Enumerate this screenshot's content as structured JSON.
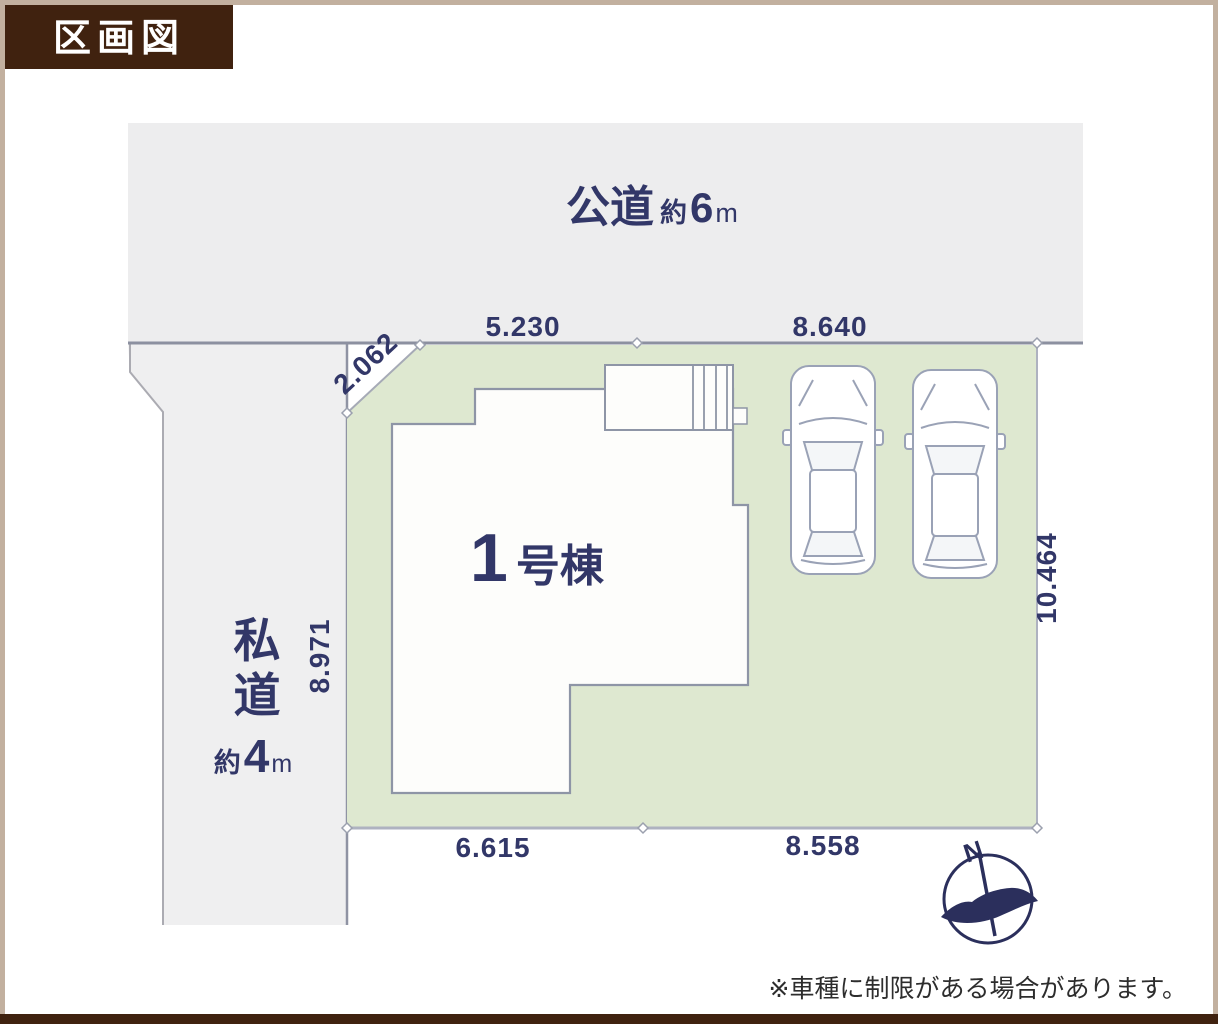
{
  "colors": {
    "brand_brown": "#40220F",
    "frame_beige": "#C2B09F",
    "navy_text": "#323768",
    "plot_green": "#DEE8D0",
    "road_gray": "#EDEDEE",
    "compass_navy": "#2B2F5C"
  },
  "badge": {
    "label": "区画図"
  },
  "roads": {
    "public": {
      "name": "公道",
      "approx": "約",
      "width": "6",
      "unit": "m"
    },
    "private": {
      "char1": "私",
      "char2": "道",
      "approx": "約",
      "width": "4",
      "unit": "m"
    }
  },
  "building": {
    "number": "1",
    "suffix": "号棟"
  },
  "dimensions": {
    "corner_diagonal": "2.062",
    "north_left": "5.230",
    "north_right": "8.640",
    "west": "8.971",
    "east": "10.464",
    "south_left": "6.615",
    "south_right": "8.558"
  },
  "compass": {
    "north_label": "N"
  },
  "footnote": {
    "text": "※車種に制限がある場合があります。"
  }
}
